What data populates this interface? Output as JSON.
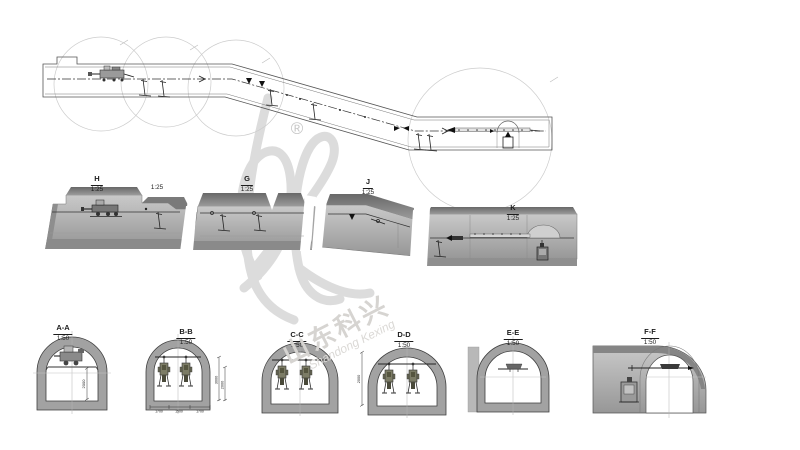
{
  "watermark": {
    "registered_symbol": "®",
    "chinese_text": "山东科兴",
    "english_text": "Shandong Kexing"
  },
  "detail_labels": [
    {
      "id": "H",
      "letter": "H",
      "scale": "1:25"
    },
    {
      "id": "G",
      "letter": "G",
      "scale": "1:25"
    },
    {
      "id": "J",
      "letter": "J",
      "scale": "1:25"
    },
    {
      "id": "K",
      "letter": "K",
      "scale": "1:25"
    }
  ],
  "extra_scale_label": "1:25",
  "cross_section_labels": [
    {
      "id": "A-A",
      "letter": "A-A",
      "scale": "1:50"
    },
    {
      "id": "B-B",
      "letter": "B-B",
      "scale": "1:50"
    },
    {
      "id": "C-C",
      "letter": "C-C",
      "scale": "1:50"
    },
    {
      "id": "D-D",
      "letter": "D-D",
      "scale": "1:50"
    },
    {
      "id": "E-E",
      "letter": "E-E",
      "scale": "1:50"
    },
    {
      "id": "F-F",
      "letter": "F-F",
      "scale": "1:50"
    }
  ],
  "dimensions": {
    "aa_height": "2000",
    "bb_right_outer": "3000",
    "bb_right_inner": "2000",
    "bb_bottom": [
      "1700",
      "1500",
      "1700"
    ],
    "dd_left": "2000"
  },
  "colors": {
    "line": "#444444",
    "slab_face": "#b5b5b5",
    "slab_top": "#6f6f6f",
    "tunnel_ring": "#a2a2a2",
    "drill_body": "#7c7c66",
    "watermark": "#dcdcdc"
  }
}
